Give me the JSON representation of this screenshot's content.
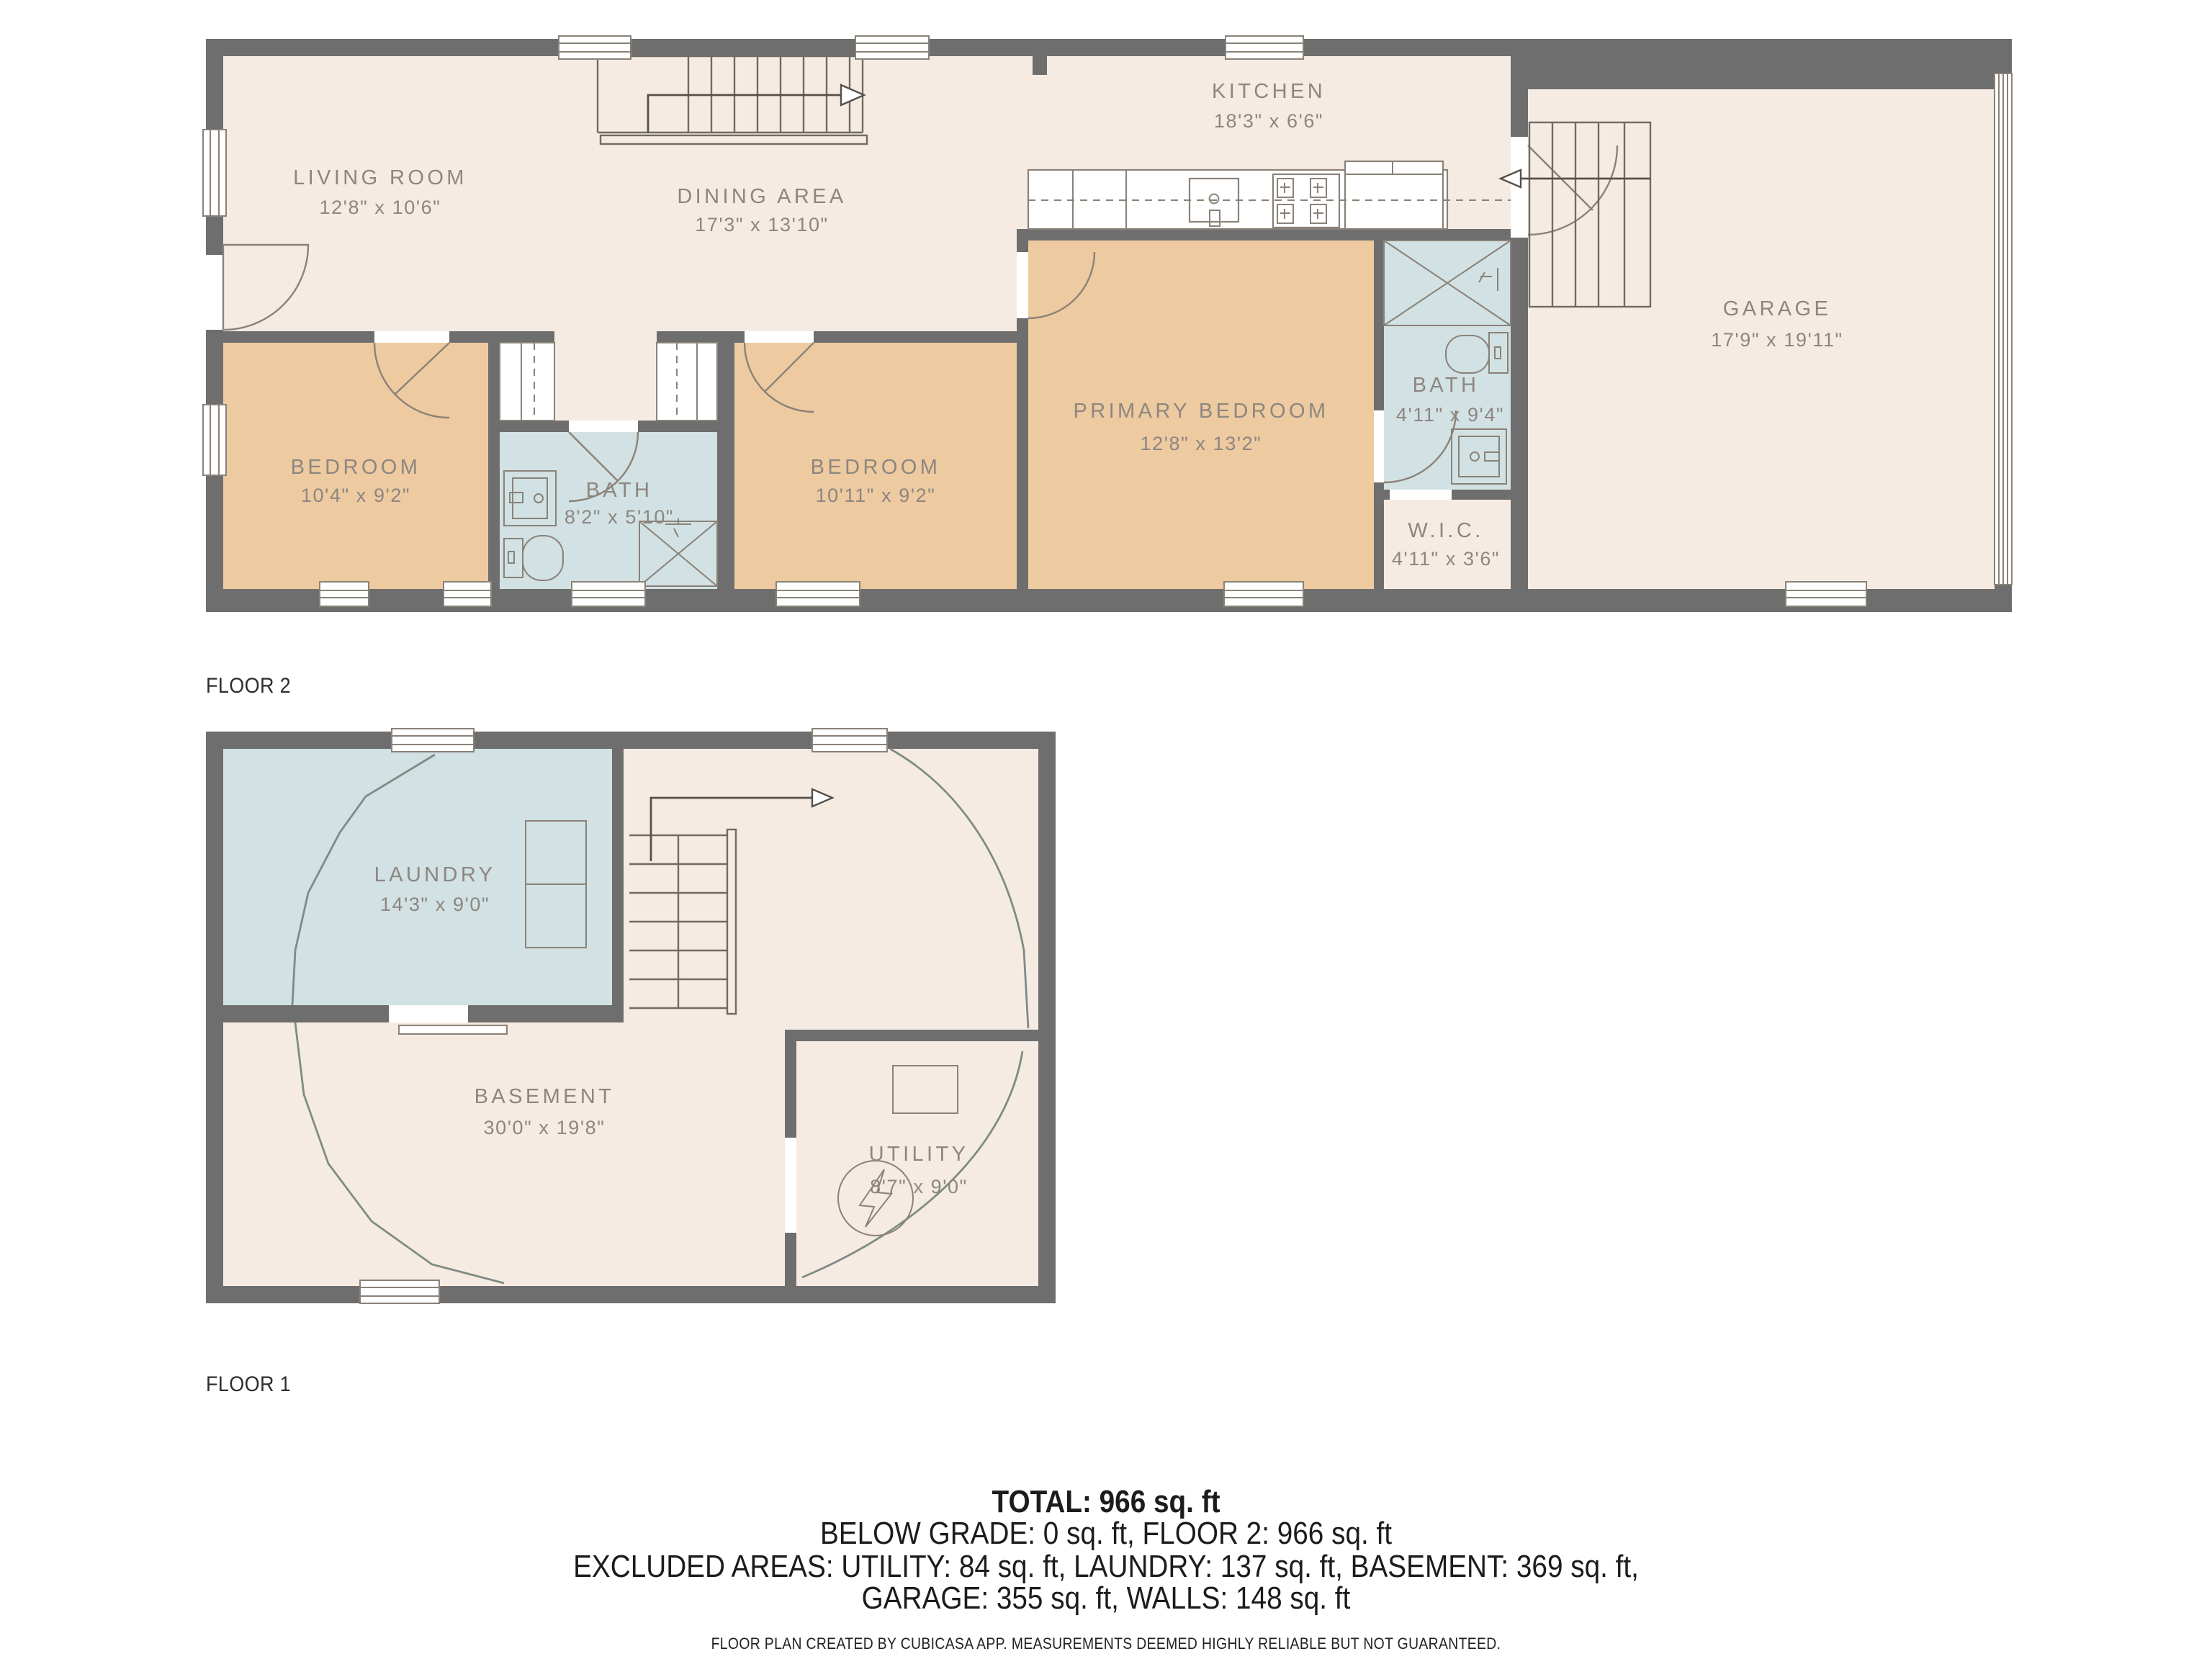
{
  "floor2": {
    "label": "FLOOR 2",
    "rooms": {
      "living_room": {
        "name": "LIVING ROOM",
        "dims": "12'8\" x 10'6\""
      },
      "dining_area": {
        "name": "DINING AREA",
        "dims": "17'3\" x 13'10\""
      },
      "kitchen": {
        "name": "KITCHEN",
        "dims": "18'3\" x 6'6\""
      },
      "bedroom_left": {
        "name": "BEDROOM",
        "dims": "10'4\" x 9'2\""
      },
      "bath_main": {
        "name": "BATH",
        "dims": "8'2\" x 5'10\""
      },
      "bedroom_middle": {
        "name": "BEDROOM",
        "dims": "10'11\" x 9'2\""
      },
      "primary_bedroom": {
        "name": "PRIMARY BEDROOM",
        "dims": "12'8\" x 13'2\""
      },
      "bath_primary": {
        "name": "BATH",
        "dims": "4'11\" x 9'4\""
      },
      "wic": {
        "name": "W.I.C.",
        "dims": "4'11\" x 3'6\""
      },
      "garage": {
        "name": "GARAGE",
        "dims": "17'9\" x 19'11\""
      }
    }
  },
  "floor1": {
    "label": "FLOOR 1",
    "rooms": {
      "laundry": {
        "name": "LAUNDRY",
        "dims": "14'3\" x 9'0\""
      },
      "basement": {
        "name": "BASEMENT",
        "dims": "30'0\" x 19'8\""
      },
      "utility": {
        "name": "UTILITY",
        "dims": "8'7\" x 9'0\""
      }
    }
  },
  "summary": {
    "total_line": "TOTAL: 966 sq. ft",
    "grade_line": "BELOW GRADE: 0 sq. ft, FLOOR 2: 966 sq. ft",
    "excluded_line_1": "EXCLUDED AREAS: UTILITY: 84 sq. ft, LAUNDRY: 137 sq. ft, BASEMENT: 369 sq. ft,",
    "excluded_line_2": "GARAGE: 355 sq. ft, WALLS: 148 sq. ft",
    "disclaimer": "FLOOR PLAN CREATED BY CUBICASA APP. MEASUREMENTS DEEMED HIGHLY RELIABLE BUT NOT GUARANTEED."
  },
  "colors": {
    "wall": "#6e6e6e",
    "floor": "#f6ebe3",
    "room_tan": "#eecaa1",
    "room_wet": "#d2e1e3",
    "line": "#8a8278",
    "label": "#8d8680",
    "curve": "#7e8c85",
    "text": "#1c1c1c"
  }
}
